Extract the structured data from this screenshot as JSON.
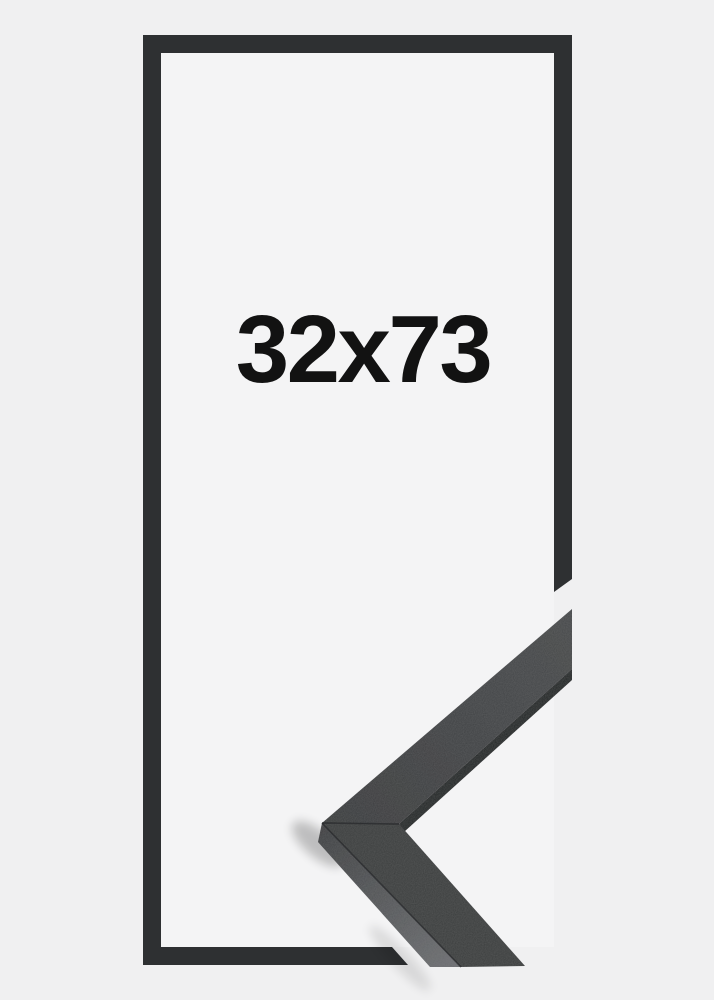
{
  "diagram": {
    "size_label": "32x73"
  },
  "theme": {
    "page_bg": "#f0f0f1",
    "inner_bg": "#f4f4f5",
    "outline": "#2e3032",
    "label": "#121212",
    "corner_front": "#3a3c3e",
    "corner_front_tip": "#47494b",
    "corner_lip": "#242527",
    "corner_side_top": "#3f4143",
    "corner_side_bottom": "#6a6c6f"
  }
}
